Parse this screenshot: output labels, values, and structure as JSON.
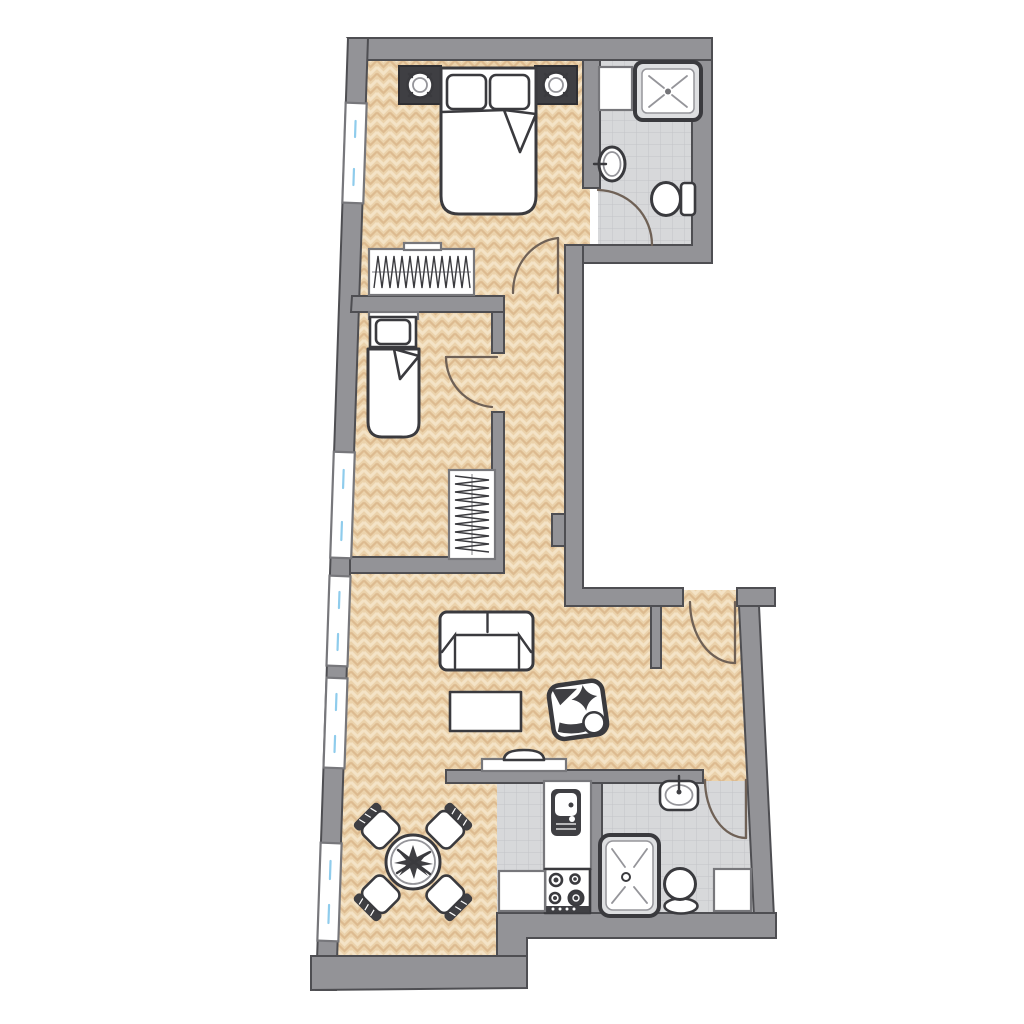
{
  "meta": {
    "title": "Apartment floor plan",
    "type": "architectural-floor-plan",
    "orientation": "vertical-strip-unit"
  },
  "colors": {
    "background": "#ffffff",
    "wall_fill": "#939397",
    "wall_stroke": "#4e4e52",
    "wood_base": "#ebd2ab",
    "wood_light": "#f4e3c6",
    "wood_dark": "#ddbb90",
    "tile_base": "#d7d8da",
    "tile_line": "#c3c4c8",
    "furn_fill": "#ffffff",
    "furn_stroke": "#3a3a3e",
    "fixture_stroke": "#77777b",
    "door_arc": "#6f6156",
    "glass": "#8fccec",
    "dark_fill": "#3f3f43",
    "shower_surround": "#dedfe1",
    "inner_line": "#95959a"
  },
  "rooms": [
    {
      "id": "bedroom-1",
      "floor": "herringbone-wood",
      "furniture": [
        "double-bed",
        "pillow",
        "pillow",
        "nightstand-lamp-left",
        "nightstand-lamp-right",
        "wardrobe-hanging-clothes",
        "window"
      ]
    },
    {
      "id": "bathroom-top",
      "floor": "tile",
      "fixtures": [
        "cabinet",
        "shower",
        "wall-sink",
        "toilet",
        "door"
      ]
    },
    {
      "id": "bedroom-2",
      "floor": "herringbone-wood",
      "furniture": [
        "single-bed",
        "pillow",
        "wardrobe-hanging-clothes",
        "window",
        "door"
      ]
    },
    {
      "id": "hallway",
      "floor": "herringbone-wood",
      "fixtures": [
        "wall-pillar"
      ]
    },
    {
      "id": "living-room",
      "floor": "herringbone-wood",
      "furniture": [
        "sofa",
        "coffee-table",
        "armchair",
        "tv-console",
        "window",
        "window"
      ]
    },
    {
      "id": "dining-area",
      "floor": "herringbone-wood",
      "furniture": [
        "round-table-with-plant",
        "chair",
        "chair",
        "chair",
        "chair",
        "window"
      ]
    },
    {
      "id": "kitchen",
      "floor": "tile",
      "fixtures": [
        "counter",
        "kitchen-sink",
        "stove-4-burners",
        "cabinet"
      ]
    },
    {
      "id": "bathroom-bottom",
      "floor": "tile",
      "fixtures": [
        "wall-sink",
        "shower",
        "toilet",
        "cabinet",
        "door"
      ]
    },
    {
      "id": "entry",
      "floor": "herringbone-wood",
      "fixtures": [
        "entrance-door",
        "partial-wall"
      ]
    }
  ],
  "counts": {
    "rooms": 9,
    "windows": 5,
    "door_swings": 5,
    "beds": 2,
    "bathrooms": 2
  }
}
